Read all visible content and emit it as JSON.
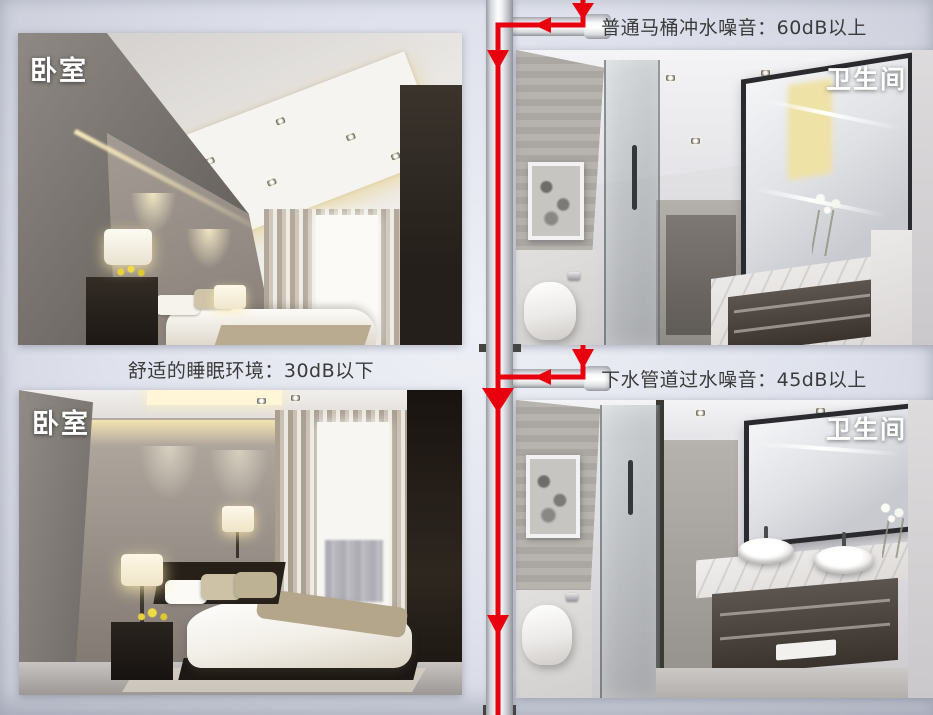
{
  "canvas": {
    "background_color": "#dfe2ec",
    "accent_red": "#e8000f",
    "pipe_color": "#f2f3f5"
  },
  "panels": {
    "bedroom_top": {
      "label": "卧室"
    },
    "bathroom_top": {
      "label": "卫生间"
    },
    "bedroom_bottom": {
      "label": "卧室"
    },
    "bathroom_bottom": {
      "label": "卫生间"
    }
  },
  "annotations": {
    "toilet_flush_noise": "普通马桶冲水噪音：60dB以上",
    "sleep_environment": "舒适的睡眠环境：30dB以下",
    "drain_pipe_noise": "下水管道过水噪音：45dB以上"
  }
}
